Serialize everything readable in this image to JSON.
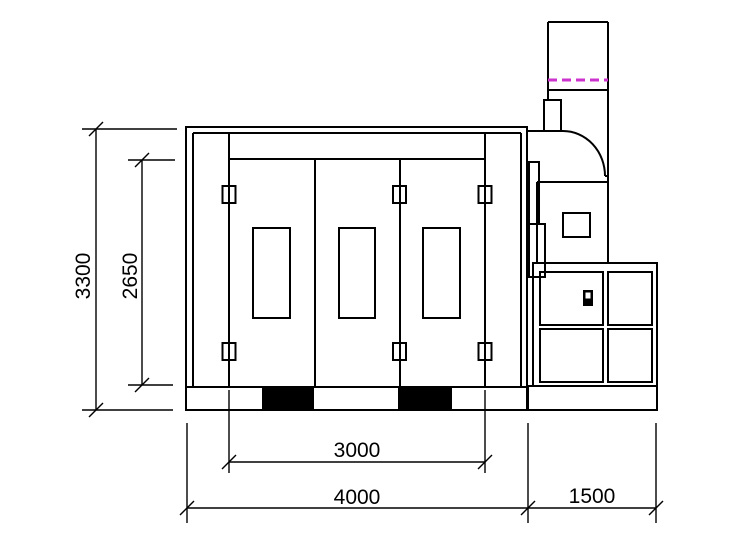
{
  "drawing": {
    "type": "technical-elevation",
    "subject": "Spray paint booth side elevation with exhaust fan unit and filter cabinet",
    "dimensions": {
      "overall_height": {
        "label": "3300",
        "orientation": "vertical"
      },
      "door_opening_height": {
        "label": "2650",
        "orientation": "vertical"
      },
      "door_opening_width": {
        "label": "3000",
        "orientation": "horizontal"
      },
      "booth_width": {
        "label": "4000",
        "orientation": "horizontal"
      },
      "machine_section_width": {
        "label": "1500",
        "orientation": "horizontal"
      }
    },
    "components": {
      "doors": 3,
      "door_windows": 3,
      "hinges": 6,
      "base_blocks": 2,
      "filter_cabinet_panels": 4
    },
    "colors": {
      "line": "#000000",
      "background": "#ffffff",
      "damper_dash_line": "#cc33cc",
      "base_block_fill": "#000000"
    }
  }
}
